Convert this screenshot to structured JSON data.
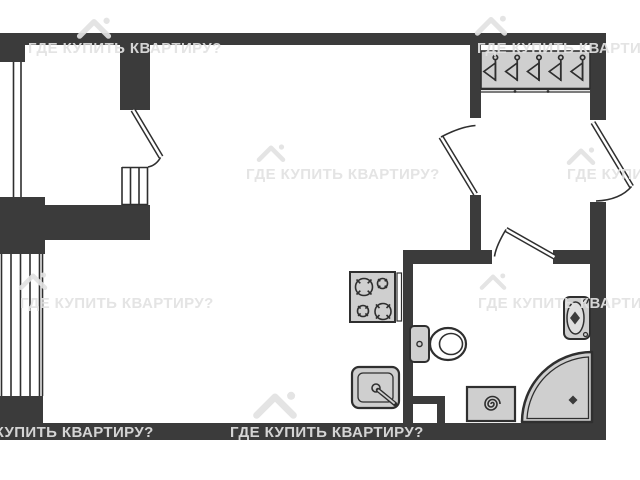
{
  "watermark": {
    "text": "ГДЕ КУПИТЬ КВАРТИРУ?"
  },
  "colors": {
    "wall": "#3b3b3b",
    "line": "#2f2f2f",
    "fixture": "#cfcfcf",
    "fixture-light": "#dedede",
    "wm": "#e2e2e2",
    "bg": "#ffffff"
  },
  "fixtures": {
    "wardrobe_hanger_count": 5,
    "stove_burner_count": 4,
    "items": [
      "wardrobe",
      "stove",
      "kitchen-sink",
      "toilet",
      "washbasin",
      "shower",
      "washing-machine",
      "balcony-window",
      "entry-door"
    ]
  }
}
